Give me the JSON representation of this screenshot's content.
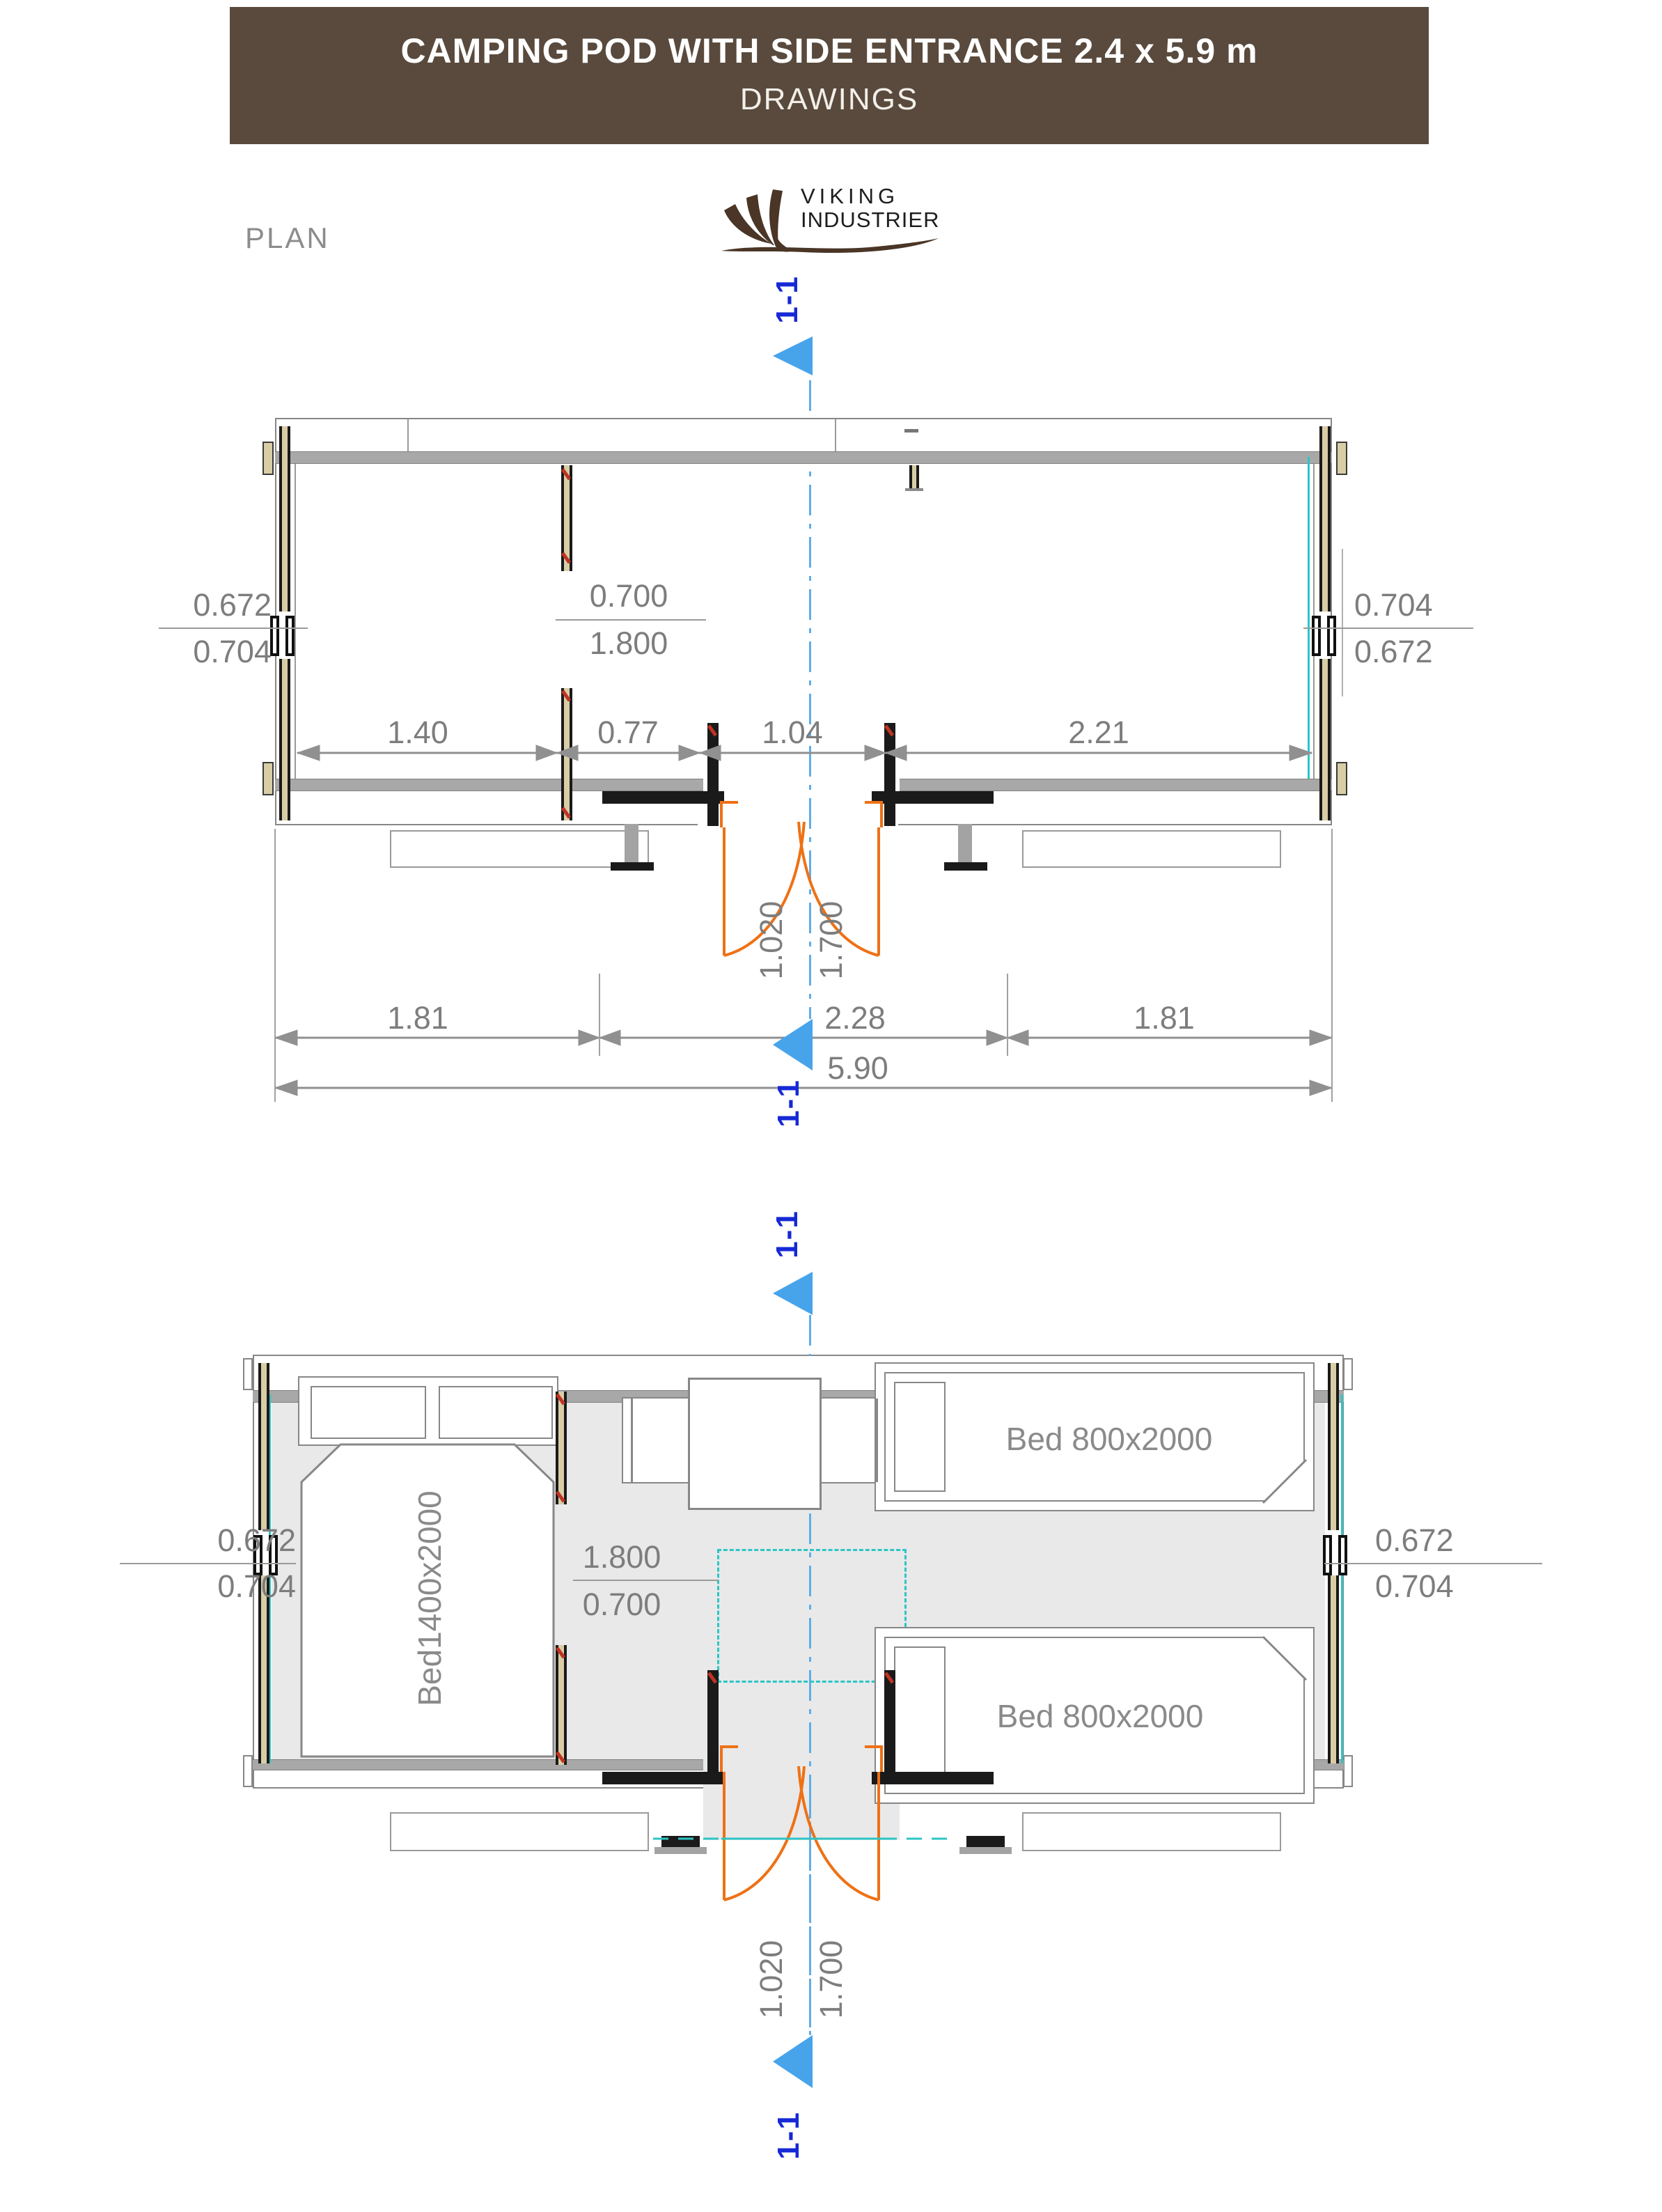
{
  "header": {
    "title": "CAMPING POD WITH SIDE ENTRANCE 2.4 x 5.9 m",
    "subtitle": "DRAWINGS",
    "bg_color": "#594a3d"
  },
  "page_label": "PLAN",
  "logo": {
    "line1": "VIKING",
    "line2": "INDUSTRIER"
  },
  "section_marker_label": "1-1",
  "colors": {
    "banner_brown": "#594a3d",
    "dim_text_gray": "#7d7d7d",
    "marker_blue_text": "#1629d6",
    "section_arrow_blue": "#47a4eb",
    "centerline_blue": "#5fadea",
    "door_swing_orange": "#ee7115",
    "window_teal": "#2dc5c5",
    "wall_stud_tan": "#d9cda6",
    "beam_gray": "#a8a8a8",
    "floor_gray": "#e9e9e9"
  },
  "top_plan": {
    "dims_left": {
      "top": "0.672",
      "bottom": "0.704"
    },
    "dims_middle": {
      "top": "0.700",
      "bottom": "1.800"
    },
    "dims_right": {
      "top": "0.704",
      "bottom": "0.672"
    },
    "interior_segments": [
      "1.40",
      "0.77",
      "1.04",
      "2.21"
    ],
    "door": {
      "width": "1.020",
      "height": "1.700"
    },
    "bottom_segments": [
      "1.81",
      "2.28",
      "1.81"
    ],
    "total_length": "5.90"
  },
  "bottom_plan": {
    "dims_left": {
      "top": "0.672",
      "bottom": "0.704"
    },
    "dims_middle": {
      "top": "1.800",
      "bottom": "0.700"
    },
    "dims_right": {
      "top": "0.672",
      "bottom": "0.704"
    },
    "door": {
      "width": "1.020",
      "height": "1.700"
    },
    "beds": {
      "double": "Bed1400x2000",
      "single_top": "Bed 800x2000",
      "single_bottom": "Bed 800x2000"
    }
  }
}
